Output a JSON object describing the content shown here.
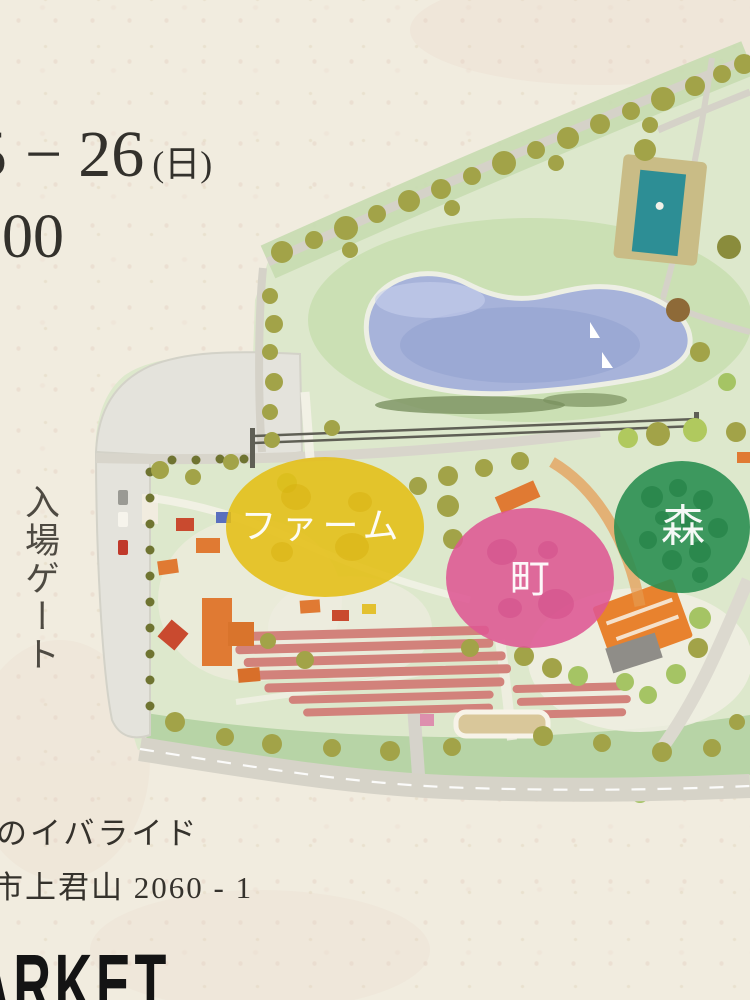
{
  "header": {
    "date_partial_digit": "5",
    "date_separator": "−",
    "date_day": "26",
    "date_weekday": "(日)",
    "time_fragment": "00"
  },
  "map": {
    "entrance_gate_label": "入場ゲート",
    "zones": {
      "farm": {
        "label": "ファーム",
        "color": "#e4be14"
      },
      "town": {
        "label": "町",
        "color": "#de5693"
      },
      "forest": {
        "label": "森",
        "color": "#2b8f52"
      }
    },
    "features": {
      "pond": "boating-pond",
      "pool": "pool",
      "parking": "parking-lot",
      "fields": "crop-rows",
      "road": "perimeter-road"
    }
  },
  "footer": {
    "venue_name_fragment": "のイバライド",
    "address_fragment": "市上君山 2060 - 1",
    "brand_fragment": "ARKET"
  },
  "palette": {
    "paper": "#f1ecdf",
    "park_green": "#dde8cc",
    "pond_blue": "#a7b3da",
    "pool_teal": "#2d8e95",
    "tree_olive": "#a2a348",
    "road_gray": "#d6d3c8",
    "building_orange": "#e07a33",
    "field_pink": "#d2827b",
    "text_dark": "#33312c"
  }
}
